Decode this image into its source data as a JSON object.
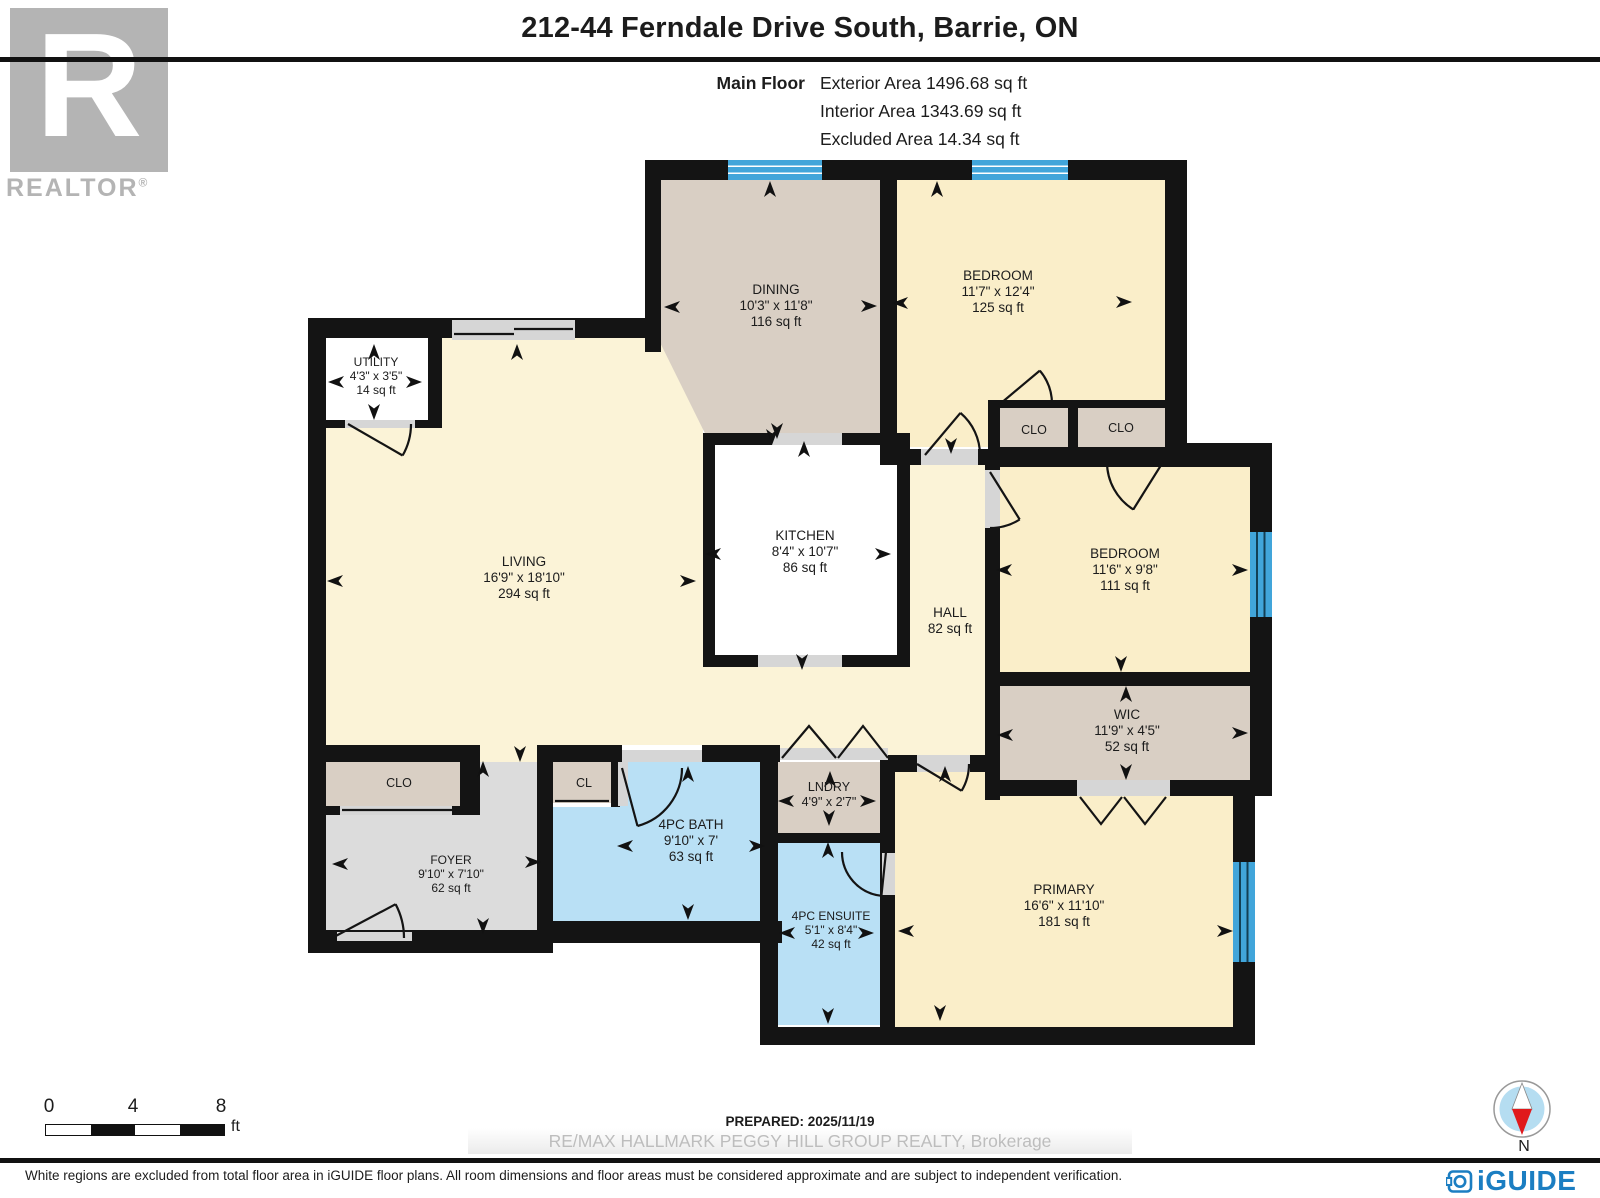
{
  "header": {
    "title": "212-44 Ferndale Drive South, Barrie, ON",
    "floor_label": "Main Floor",
    "areas": {
      "exterior": "Exterior Area 1496.68 sq ft",
      "interior": "Interior Area 1343.69 sq ft",
      "excluded": "Excluded Area 14.34 sq ft"
    }
  },
  "logos": {
    "realtor_letter": "R",
    "realtor_text": "REALTOR",
    "realtor_reg": "®",
    "iguide_text": "iGUIDE"
  },
  "rooms": {
    "living": {
      "name": "LIVING",
      "dims": "16'9\" x 18'10\"",
      "area": "294 sq ft"
    },
    "dining": {
      "name": "DINING",
      "dims": "10'3\" x 11'8\"",
      "area": "116 sq ft"
    },
    "bedroom1": {
      "name": "BEDROOM",
      "dims": "11'7\" x 12'4\"",
      "area": "125 sq ft"
    },
    "bedroom2": {
      "name": "BEDROOM",
      "dims": "11'6\" x 9'8\"",
      "area": "111 sq ft"
    },
    "kitchen": {
      "name": "KITCHEN",
      "dims": "8'4\" x 10'7\"",
      "area": "86 sq ft"
    },
    "hall": {
      "name": "HALL",
      "area": "82 sq ft"
    },
    "wic": {
      "name": "WIC",
      "dims": "11'9\" x 4'5\"",
      "area": "52 sq ft"
    },
    "utility": {
      "name": "UTILITY",
      "dims": "4'3\" x 3'5\"",
      "area": "14 sq ft"
    },
    "foyer": {
      "name": "FOYER",
      "dims": "9'10\" x 7'10\"",
      "area": "62 sq ft"
    },
    "bath": {
      "name": "4PC BATH",
      "dims": "9'10\" x 7'",
      "area": "63 sq ft"
    },
    "ensuite": {
      "name": "4PC ENSUITE",
      "dims": "5'1\" x 8'4\"",
      "area": "42 sq ft"
    },
    "lndry": {
      "name": "LNDRY",
      "dims": "4'9\" x 2'7\""
    },
    "primary": {
      "name": "PRIMARY",
      "dims": "16'6\" x 11'10\"",
      "area": "181 sq ft"
    }
  },
  "closets": {
    "clo": "CLO",
    "cl": "CL"
  },
  "scale": {
    "t0": "0",
    "t4": "4",
    "t8": "8",
    "unit": "ft"
  },
  "compass": {
    "n": "N"
  },
  "footer": {
    "prepared": "PREPARED: 2025/11/19",
    "watermark": "RE/MAX HALLMARK PEGGY HILL GROUP REALTY, Brokerage",
    "disclaimer": "White regions are excluded from total floor area in iGUIDE floor plans. All room dimensions and floor areas must be considered approximate and are subject to independent verification."
  },
  "colors": {
    "wall": "#141414",
    "window_blue": "#41a5da",
    "floor_cream": "#fbf3d7",
    "floor_bedroom": "#faeec9",
    "floor_tan": "#d9cfc4",
    "floor_kitchen": "#dfeee7",
    "floor_bath": "#b9e0f5",
    "floor_foyer": "#dcdcdc",
    "iguide_blue": "#1b7ec2",
    "realtor_gray": "#b4b4b4",
    "compass_red": "#e0191c"
  }
}
